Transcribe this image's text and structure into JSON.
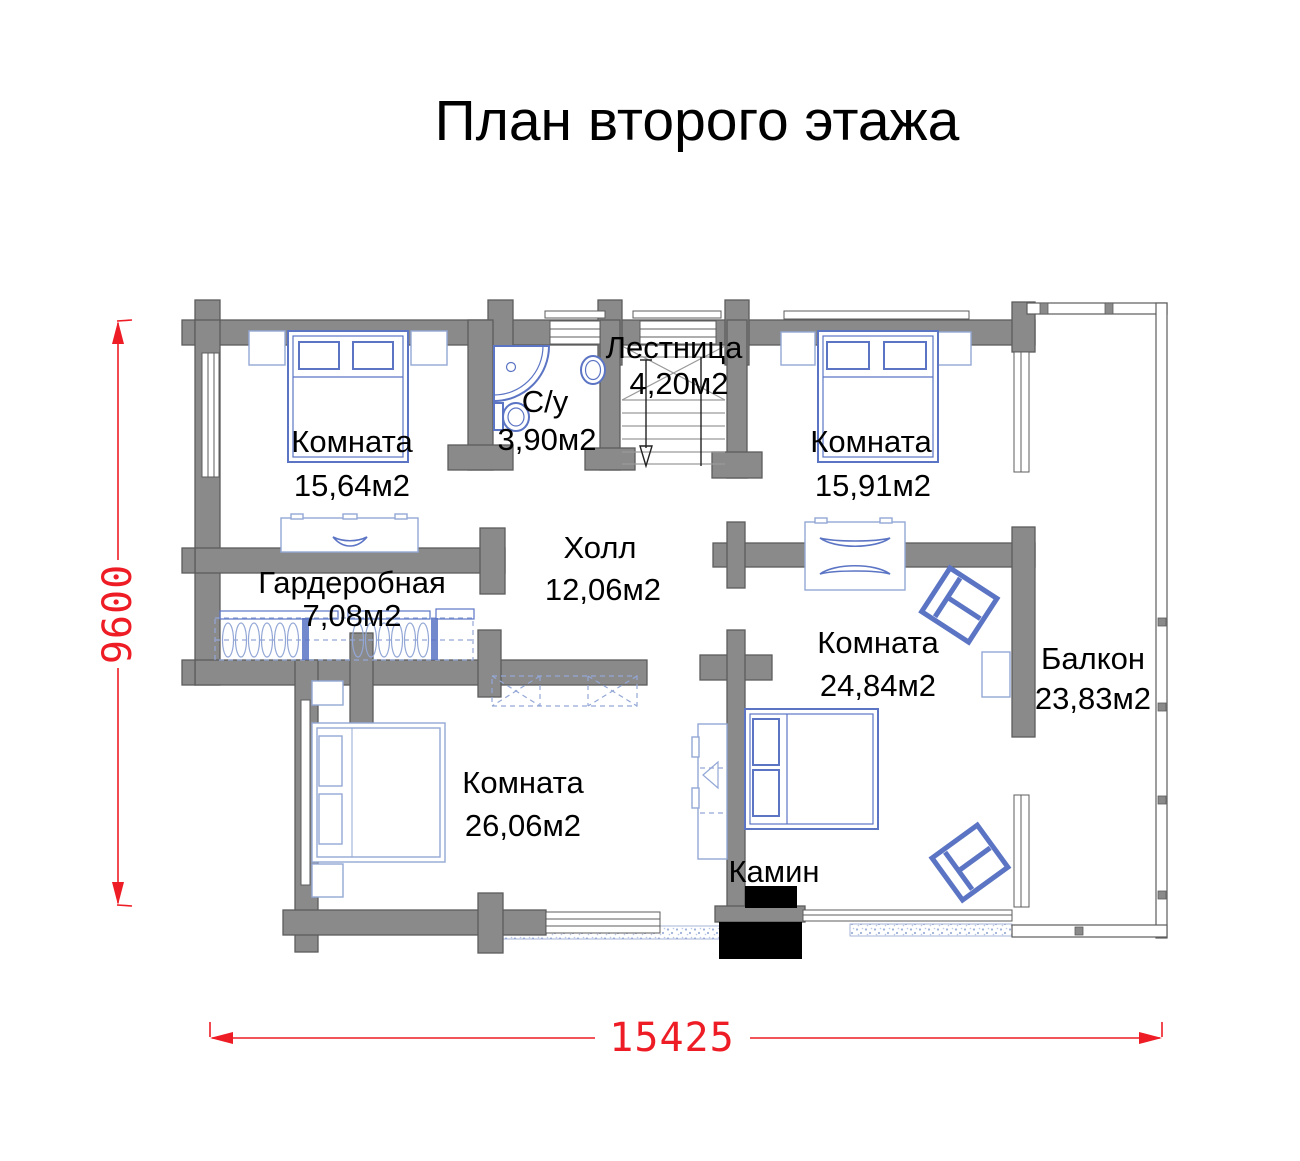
{
  "title": "План второго этажа",
  "dimensions": {
    "height_label": "9600",
    "width_label": "15425"
  },
  "rooms": [
    {
      "id": "room-top-left",
      "name": "Комната",
      "area": "15,64м2"
    },
    {
      "id": "bathroom",
      "name": "С/у",
      "area": "3,90м2"
    },
    {
      "id": "stairs",
      "name": "Лестница",
      "area": "4,20м2"
    },
    {
      "id": "room-top-right",
      "name": "Комната",
      "area": "15,91м2"
    },
    {
      "id": "hall",
      "name": "Холл",
      "area": "12,06м2"
    },
    {
      "id": "wardrobe-room",
      "name": "Гардеробная",
      "area": "7,08м2"
    },
    {
      "id": "room-right",
      "name": "Комната",
      "area": "24,84м2"
    },
    {
      "id": "balcony",
      "name": "Балкон",
      "area": "23,83м2"
    },
    {
      "id": "room-bottom-left",
      "name": "Комната",
      "area": "26,06м2"
    },
    {
      "id": "fireplace",
      "name": "Камин",
      "area": ""
    }
  ],
  "colors": {
    "wall": "#8a8a8a",
    "wall_outline": "#5c5c5c",
    "furniture": "#5b74c4",
    "furniture_light": "#93a7d6",
    "hatch_dot": "#9db0d8",
    "dimension": "#ee1c25",
    "text": "#000000",
    "fireplace": "#000000"
  }
}
